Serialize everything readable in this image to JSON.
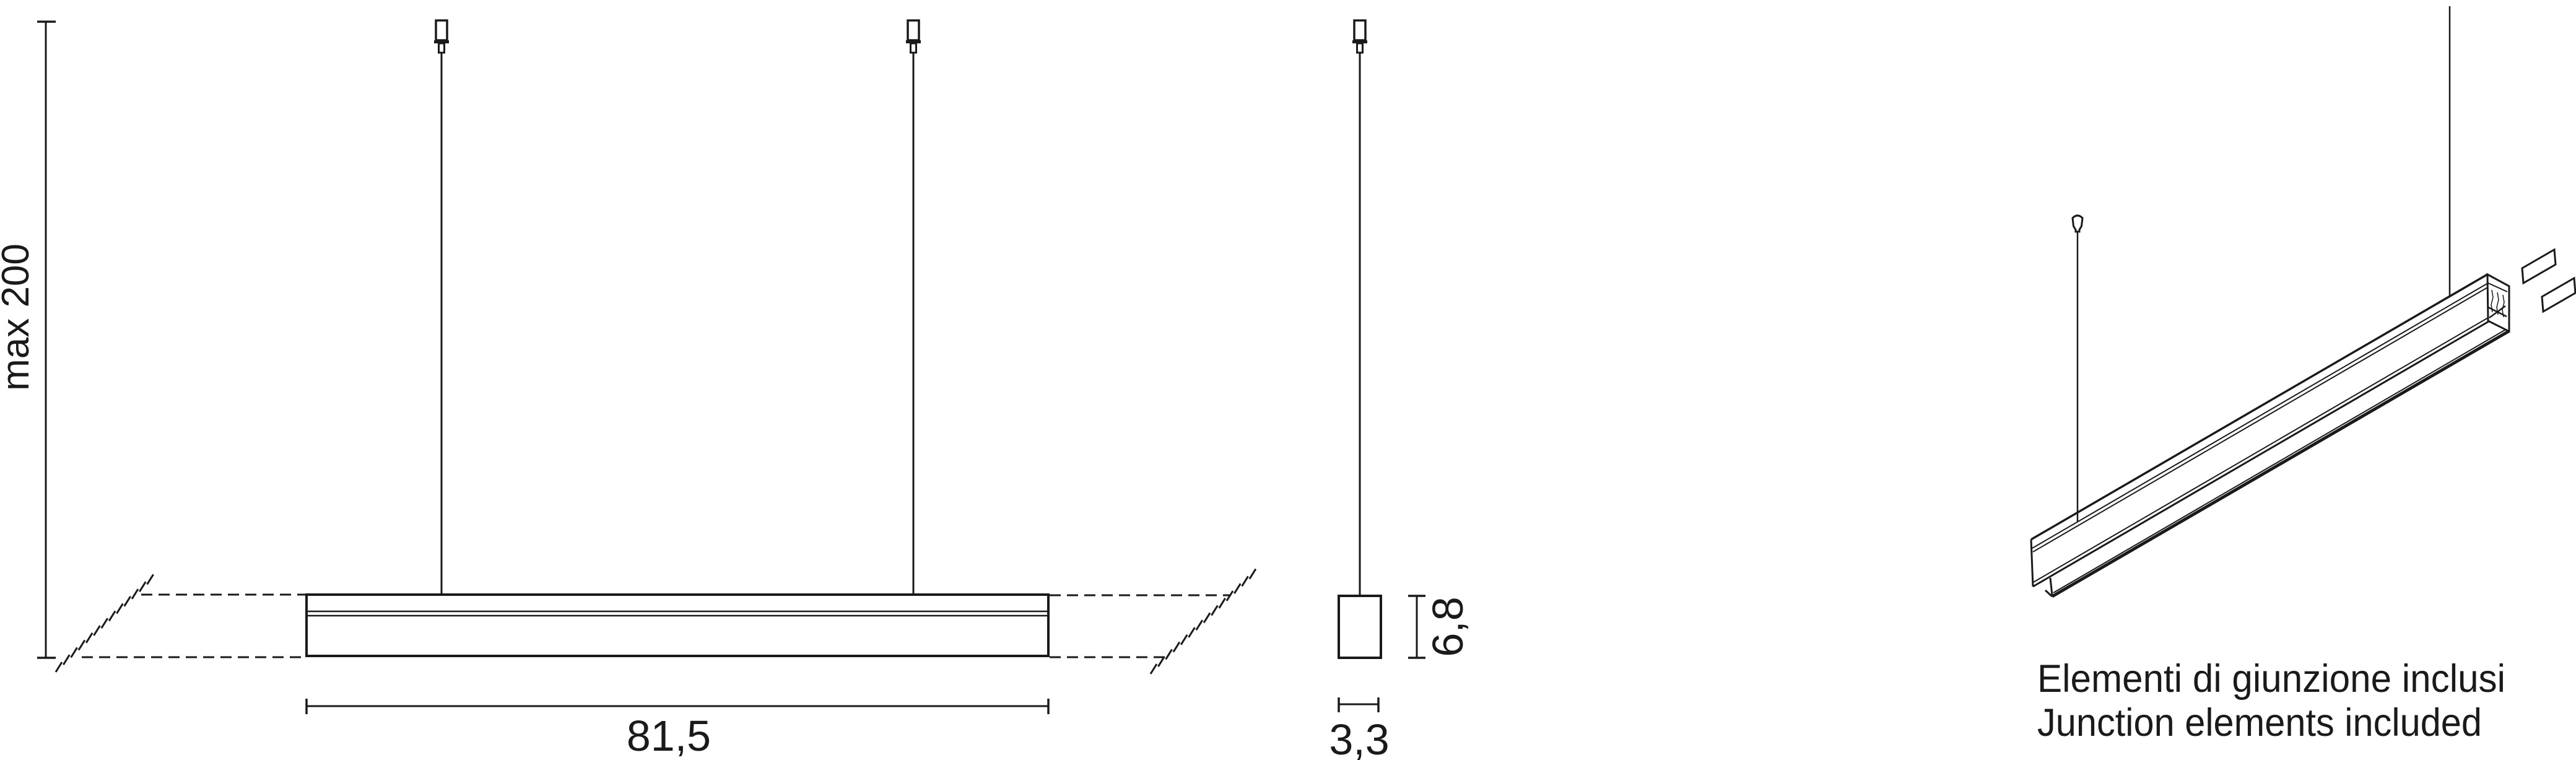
{
  "front_view": {
    "suspension_max_label": "max 200",
    "length_label": "81,5"
  },
  "side_view": {
    "height_label": "6,8",
    "width_label": "3,3"
  },
  "caption": {
    "primary": "Elementi di giunzione inclusi",
    "secondary": "Junction elements included"
  },
  "colors": {
    "line": "#1a1a1a",
    "caption_secondary": "#b3b3b3",
    "background": "#ffffff"
  }
}
